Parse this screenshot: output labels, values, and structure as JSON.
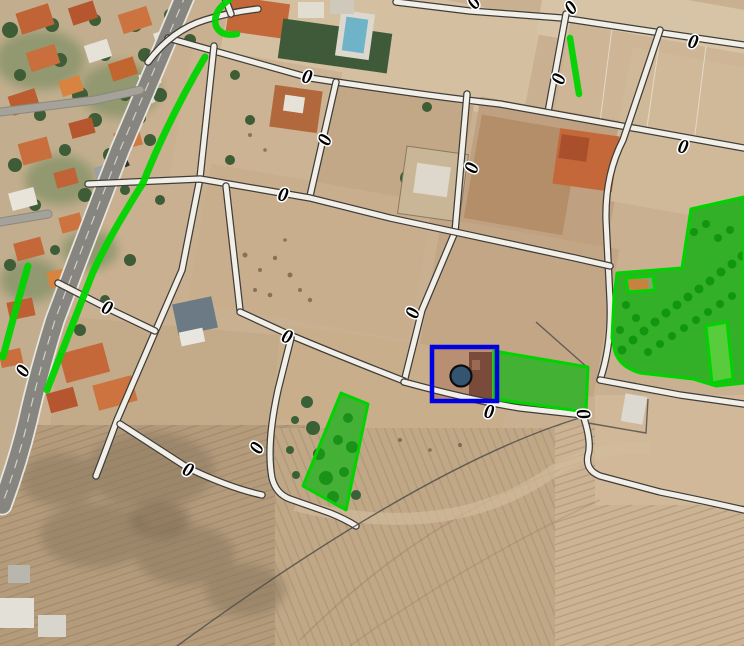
{
  "map": {
    "base_color": "#c9b091",
    "label_style": {
      "text": "0",
      "font_size": 20,
      "color": "#000000",
      "halo": "#ffffff"
    },
    "labels": [
      {
        "x": 307,
        "y": 77,
        "rot": 12
      },
      {
        "x": 683,
        "y": 147,
        "rot": 12
      },
      {
        "x": 472,
        "y": 168,
        "rot": -73
      },
      {
        "x": 325,
        "y": 140,
        "rot": -68
      },
      {
        "x": 283,
        "y": 195,
        "rot": 12
      },
      {
        "x": 489,
        "y": 412,
        "rot": 8
      },
      {
        "x": 583,
        "y": 414,
        "rot": 80
      },
      {
        "x": 188,
        "y": 470,
        "rot": 22
      },
      {
        "x": 257,
        "y": 448,
        "rot": -65
      },
      {
        "x": 107,
        "y": 308,
        "rot": 22
      },
      {
        "x": 23,
        "y": 371,
        "rot": -62
      },
      {
        "x": 287,
        "y": 337,
        "rot": 20
      },
      {
        "x": 413,
        "y": 313,
        "rot": -72
      },
      {
        "x": 571,
        "y": 8,
        "rot": -45
      },
      {
        "x": 693,
        "y": 42,
        "rot": 12
      },
      {
        "x": 559,
        "y": 79,
        "rot": -72
      },
      {
        "x": 474,
        "y": 3,
        "rot": -50
      }
    ],
    "roads": [
      {
        "name": "main-road",
        "type": "main",
        "d": "M186,-6 Q150,80 120,150 Q85,240 55,320 Q38,375 28,420 Q18,462 2,505"
      },
      {
        "name": "road-top",
        "type": "cadastral",
        "d": "M396,2 L470,11 L562,18 Q640,30 744,45"
      },
      {
        "name": "road-v8",
        "type": "cadastral",
        "d": "M566,14 L548,112"
      },
      {
        "name": "road-h1",
        "type": "cadastral",
        "d": "M168,38 L310,78 Q420,95 500,104 L744,148"
      },
      {
        "name": "road-v1",
        "type": "cadastral",
        "d": "M214,46 L200,178 L182,270 L155,332 L117,420 Q106,450 96,476"
      },
      {
        "name": "road-v2",
        "type": "cadastral",
        "d": "M336,82 L310,196"
      },
      {
        "name": "road-v4",
        "type": "cadastral",
        "d": "M467,94 L455,232 L422,310 L404,382"
      },
      {
        "name": "road-v5",
        "type": "cadastral",
        "d": "M660,30 L623,140 Q605,175 606,220 L610,300 Q612,345 600,380"
      },
      {
        "name": "road-h2",
        "type": "cadastral",
        "d": "M88,184 L200,179 L310,198 L390,218 L455,232 Q520,246 575,258 L610,266"
      },
      {
        "name": "road-v1c",
        "type": "cadastral",
        "d": "M226,186 L240,310"
      },
      {
        "name": "road-c",
        "type": "cadastral",
        "d": "M240,312 L290,335 Q340,356 404,381"
      },
      {
        "name": "road-v6",
        "type": "cadastral",
        "d": "M291,338 L278,390 Q266,445 272,478 Q276,494 290,499 L330,513 Q345,519 356,526"
      },
      {
        "name": "road-d",
        "type": "cadastral",
        "d": "M120,424 L188,468 Q230,488 262,495"
      },
      {
        "name": "road-c2",
        "type": "cadastral",
        "d": "M404,382 Q470,400 520,408 L583,415"
      },
      {
        "name": "road-g",
        "type": "cadastral",
        "d": "M583,415 Q592,442 588,455 Q585,470 600,476 L660,492 Q700,500 744,510"
      },
      {
        "name": "road-f",
        "type": "cadastral",
        "d": "M600,380 L680,395 Q715,400 744,404"
      },
      {
        "name": "road-x",
        "type": "cadastral",
        "d": "M58,283 L107,308 L155,331"
      },
      {
        "name": "road-curve-top",
        "type": "cadastral",
        "d": "M148,62 Q172,30 205,20 Q230,12 258,9"
      },
      {
        "name": "road-stub-top",
        "type": "cadastral",
        "d": "M231,14 L225,-2"
      },
      {
        "name": "street-1",
        "type": "street",
        "d": "M0,112 L95,100 L140,90"
      },
      {
        "name": "street-2",
        "type": "street",
        "d": "M0,222 L48,214"
      }
    ],
    "boundary_lines": [
      {
        "name": "field-boundary-long",
        "d": "M583,417 Q430,462 177,646"
      },
      {
        "name": "field-boundary-short",
        "d": "M536,322 L588,368"
      },
      {
        "name": "field-boundary-plot",
        "d": "M588,423 L646,433 L648,399"
      }
    ],
    "overlay": {
      "stroke": "#00d400",
      "parcels": [
        {
          "name": "parcel-overlay-large",
          "d": "M691,209 L744,197 L744,383 L716,386 L693,379 L640,373 Q620,367 615,352 L612,338 L614,296 L617,273 L682,268 Z M626,278 L653,276 L655,290 L628,292 Z",
          "fill": "rgba(0,185,0,0.62)"
        },
        {
          "name": "parcel-overlay-inner",
          "d": "M706,326 L727,322 L733,379 L712,383 Z",
          "fill": "rgba(120,228,80,0.55)"
        },
        {
          "name": "parcel-overlay-center",
          "d": "M494,351 L588,367 L586,412 L494,399 Z",
          "fill": "rgba(0,185,0,0.6)"
        },
        {
          "name": "parcel-overlay-west",
          "d": "M341,393 L368,404 L346,510 L303,486 Z",
          "fill": "rgba(0,185,0,0.55)"
        }
      ],
      "lines": [
        {
          "name": "green-line-long",
          "d": "M205,57 Q168,120 143,183 Q110,235 93,272 L47,390",
          "width": 7
        },
        {
          "name": "green-line-hook",
          "d": "M229,0 Q212,12 216,26 Q221,37 237,34",
          "width": 6.5
        },
        {
          "name": "green-line-left",
          "d": "M28,266 Q14,315 3,357",
          "width": 7
        },
        {
          "name": "green-line-north",
          "d": "M570,38 L579,94",
          "width": 6.5
        }
      ]
    },
    "selection": {
      "stroke": "#0000e0",
      "stroke_width": 4.5,
      "rect": {
        "x": 432,
        "y": 347,
        "width": 65,
        "height": 54
      },
      "marker": {
        "cx": 461,
        "cy": 376,
        "r": 10.5,
        "fill": "#335572",
        "stroke": "#0d0d0d",
        "stroke_width": 2.2
      }
    }
  }
}
